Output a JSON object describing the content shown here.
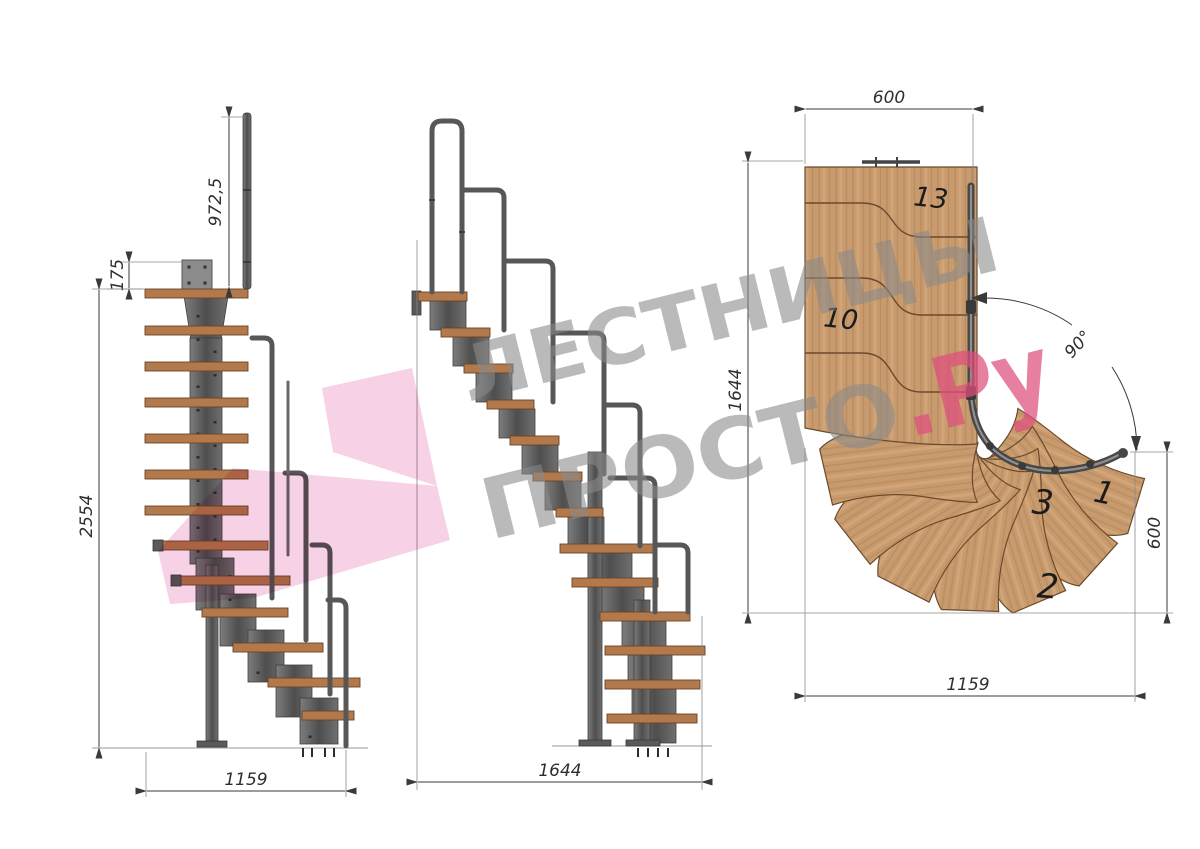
{
  "drawing": {
    "type": "modular staircase technical drawing, 90-degree turn",
    "side_view": {
      "dims": {
        "rail_height": "972,5",
        "plate_offset": "175",
        "total_height": "2554",
        "length": "1159"
      }
    },
    "front_view": {
      "dims": {
        "length": "1644"
      }
    },
    "plan_view": {
      "dims": {
        "top_width": "600",
        "depth": "1644",
        "angle": "90°",
        "side_width": "600",
        "length": "1159"
      },
      "step_labels": {
        "s13": "13",
        "s10": "10",
        "s3": "3",
        "s1": "1",
        "s2": "2"
      }
    },
    "watermark": {
      "line1": "ЛЕСТНИЦЫ",
      "line2": "ПРОСТО",
      "suffix": ".Ру"
    },
    "colors": {
      "wood_plan": "#c89b6f",
      "wood_tread": "#b1794c",
      "metal": "#5a5a5a",
      "dimension": "#3a3a3a",
      "watermark_gray": "#8a8a8a",
      "watermark_pink": "#df4f7e",
      "logo_pink": "#f0a3cd"
    }
  }
}
